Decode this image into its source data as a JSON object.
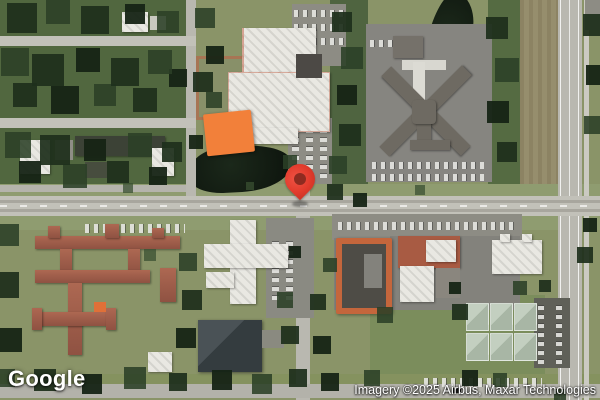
{
  "map": {
    "view_type": "satellite",
    "branding": {
      "logo_text": "Google"
    },
    "attribution": {
      "text": "Imagery ©2025 Airbus, Maxar Technologies"
    },
    "marker": {
      "type": "location-pin",
      "color": "#E23B2C",
      "inner_dot_color": "#8E2B20"
    },
    "colors": {
      "tree_canopy": "#2C4429",
      "grass": "#8A9468",
      "road": "#C2C1B9",
      "water": "#121C12",
      "building_white": "#E9E8E2",
      "building_orange": "#F2803A",
      "building_terracotta": "#9D5A49"
    }
  }
}
